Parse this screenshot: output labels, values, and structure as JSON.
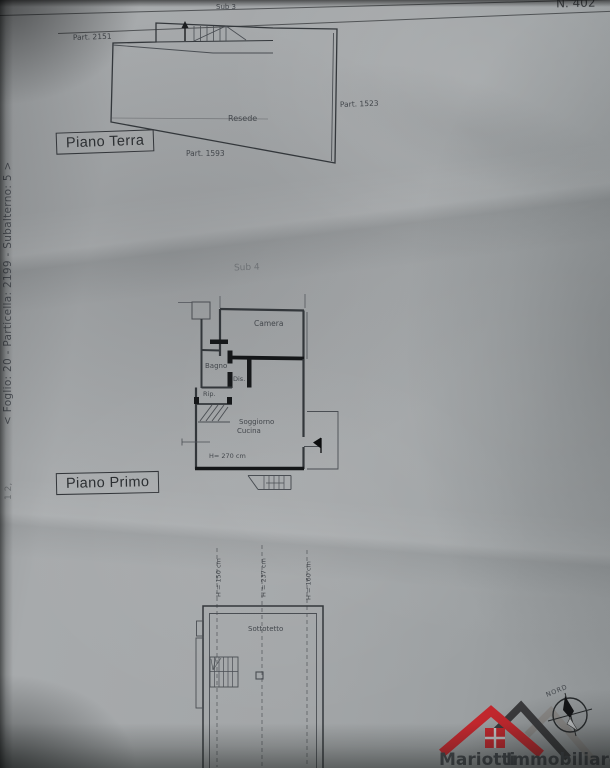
{
  "header": {
    "doc_number": "N. 402",
    "margin_reference": "< Foglio: 20 - Particella: 2199 - Subalterno: 5 >",
    "margin_fragment": "1 2,"
  },
  "ground_floor": {
    "title": "Piano Terra",
    "sub": "Sub 3",
    "part_left": "Part. 2151",
    "part_right": "Part. 1523",
    "part_bottom": "Part. 1593",
    "courtyard": "Resede"
  },
  "first_floor": {
    "title": "Piano Primo",
    "sub": "Sub 4",
    "camera": "Camera",
    "bagno": "Bagno",
    "dis": "Dis.",
    "rip": "Rip.",
    "soggiorno": "Soggiorno",
    "cucina": "Cucina",
    "height": "H= 270 cm"
  },
  "attic": {
    "room": "Sottotetto",
    "h_left": "H = 150 cm",
    "h_mid": "H = 237 cm",
    "h_right": "H = 160 cm"
  },
  "logo": {
    "name_a": "Mariotti",
    "name_b": "Immobiliare",
    "compass": "NORD",
    "color_red": "#c1272d",
    "color_dark": "#3a3a3c",
    "color_gray": "#8c8a88"
  }
}
